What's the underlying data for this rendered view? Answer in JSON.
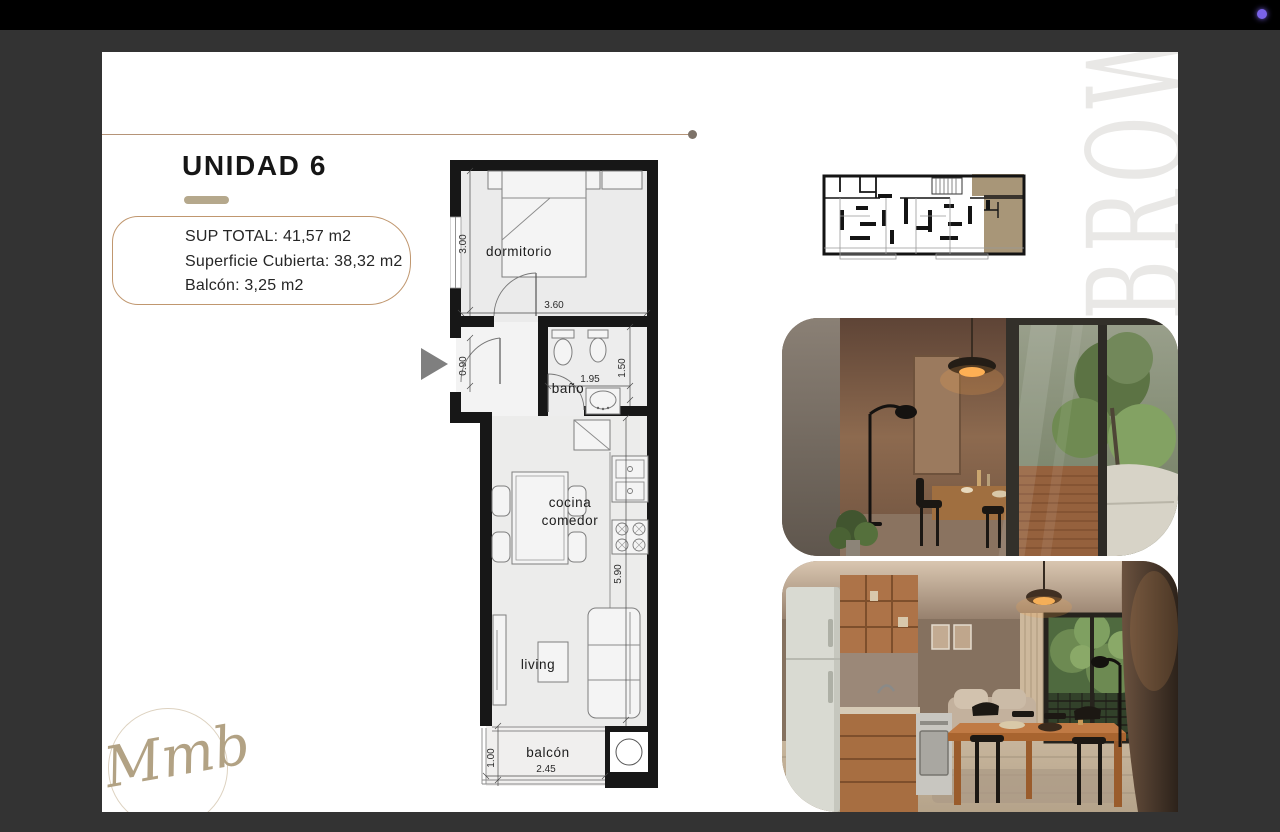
{
  "screen": {
    "top_bar_color": "#000000",
    "background_color": "#333333",
    "status_dot_color": "#7a63e8"
  },
  "slide": {
    "title": "UNIDAD 6",
    "info": {
      "sup_total": "SUP TOTAL: 41,57 m2",
      "superficie_cubierta": "Superficie Cubierta: 38,32 m2",
      "balcon": "Balcón: 3,25 m2"
    },
    "watermark": "BROWN",
    "signature": "Mmb",
    "accent": {
      "underline": "#b5a88c",
      "box_border": "#c0976f",
      "divider_line": "#b59478",
      "divider_dot": "#7d7268",
      "key_plan_highlight": "#a89678",
      "watermark_color": "#e9e8e6"
    }
  },
  "floor_plan": {
    "labels": {
      "dormitorio": "dormitorio",
      "bano": "baño",
      "cocina": "cocina",
      "comedor": "comedor",
      "living": "living",
      "balcon": "balcón"
    },
    "dimensions": {
      "dorm_depth": "3.00",
      "dorm_width": "3.60",
      "entry_width": "0.90",
      "bano_width": "1.95",
      "bano_depth": "1.50",
      "main_depth": "5.90",
      "balcon_depth": "1.00",
      "balcon_width": "2.45"
    }
  }
}
